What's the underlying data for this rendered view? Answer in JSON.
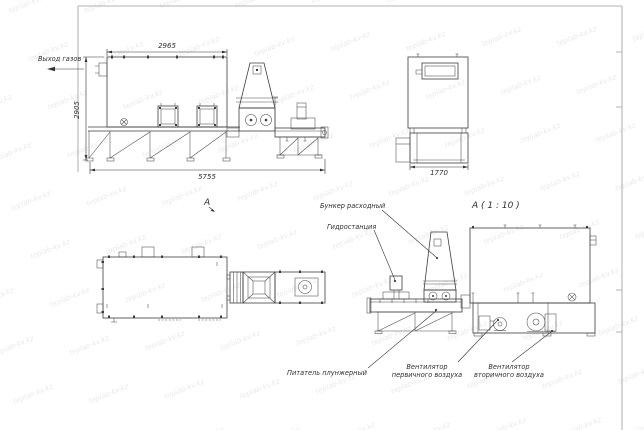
{
  "watermark": {
    "text": "teplab-kv.kz"
  },
  "colors": {
    "line": "#3d3d3d",
    "dimension": "#333333",
    "watermark": "#e9e9e9",
    "frame": "#9a9a9a",
    "background": "#ffffff"
  },
  "views": {
    "front_elevation": {
      "gas_outlet_label": "Выход газов",
      "dim_body_length": "2965",
      "dim_height": "2905",
      "dim_total_length": "5755"
    },
    "end_elevation": {
      "dim_width": "1770"
    },
    "plan_view": {
      "label": "А"
    },
    "section_view": {
      "title": "А ( 1 : 10 )",
      "callouts": {
        "hopper": "Бункер расходный",
        "hydro_station": "Гидростанция",
        "plunger_feeder": "Питатель плунжерный",
        "fan_primary_line1": "Вентилятор",
        "fan_primary_line2": "первичного воздуха",
        "fan_secondary_line1": "Вентилятор",
        "fan_secondary_line2": "вторичного воздуха"
      }
    }
  }
}
